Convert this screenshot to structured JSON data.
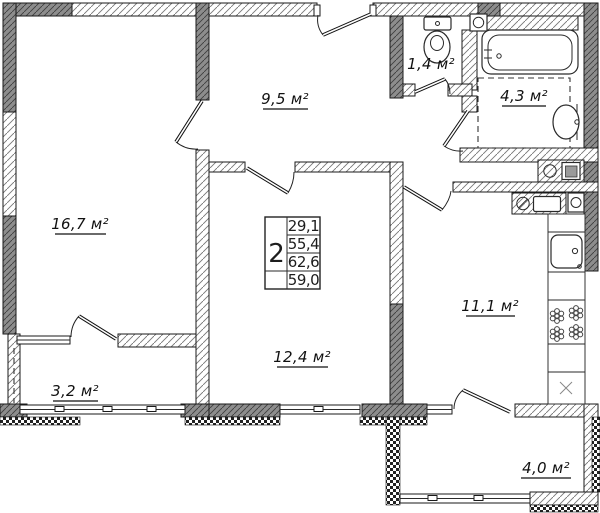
{
  "colors": {
    "wall_gray": "#8d8d8d",
    "line": "#1a1a1a"
  },
  "rooms": [
    {
      "name": "living-room",
      "area_label": "16,7 м²"
    },
    {
      "name": "hallway",
      "area_label": "9,5 м²"
    },
    {
      "name": "toilet",
      "area_label": "1,4 м²"
    },
    {
      "name": "bathroom",
      "area_label": "4,3 м²"
    },
    {
      "name": "kitchen",
      "area_label": "11,1 м²"
    },
    {
      "name": "bedroom",
      "area_label": "12,4 м²"
    },
    {
      "name": "balcony-left",
      "area_label": "3,2 м²"
    },
    {
      "name": "balcony-right",
      "area_label": "4,0 м²"
    }
  ],
  "stamp": {
    "room_count": "2",
    "values": [
      "29,1",
      "55,4",
      "62,6",
      "59,0"
    ]
  }
}
